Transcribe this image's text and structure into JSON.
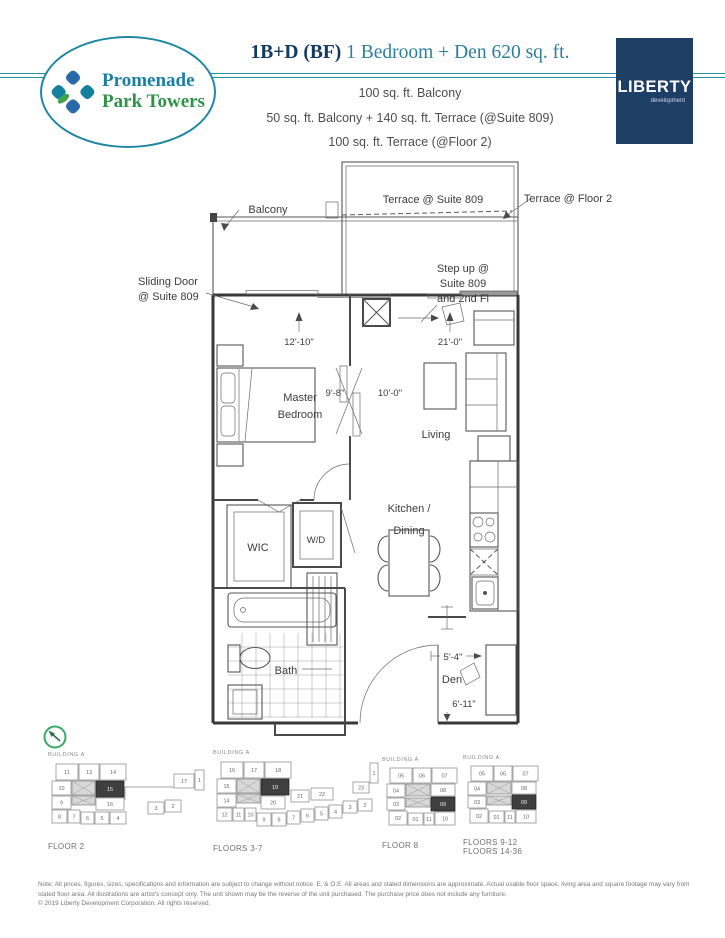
{
  "header": {
    "logo": {
      "line1": "Promenade",
      "line2": "Park Towers"
    },
    "unit_code": "1B+D (BF)",
    "unit_desc": "1 Bedroom + Den 620 sq. ft.",
    "area_lines": [
      "100 sq. ft. Balcony",
      "50 sq. ft. Balcony  + 140 sq. ft. Terrace (@Suite 809)",
      "100 sq. ft. Terrace (@Floor 2)"
    ],
    "developer": {
      "name": "LIBERTY",
      "tagline": "development"
    }
  },
  "plan": {
    "labels": {
      "terrace_suite": "Terrace @ Suite 809",
      "terrace_floor": "Terrace @ Floor 2",
      "balcony": "Balcony",
      "sliding_door": [
        "Sliding Door",
        "@ Suite 809"
      ],
      "step_up": [
        "Step up @",
        "Suite 809",
        "and 2nd Fl"
      ],
      "master_bedroom": [
        "Master",
        "Bedroom"
      ],
      "living": "Living",
      "kitchen_dining": [
        "Kitchen /",
        "Dining"
      ],
      "wic": "WIC",
      "wd": "W/D",
      "bath": "Bath",
      "den": "Den"
    },
    "dimensions": {
      "bedroom_width": "12'-10\"",
      "living_width": "21'-0\"",
      "bedroom_depth": "9'-8\"",
      "living_depth": "10'-0\"",
      "den_width": "5'-4\"",
      "den_depth": "6'-11\""
    }
  },
  "keyplans": [
    {
      "building": "BUILDING A",
      "floors": [
        "FLOOR 2"
      ],
      "shape": "podium16",
      "highlight": "15",
      "units": [
        "11",
        "13",
        "14",
        "10",
        "15",
        "9",
        "16",
        "8",
        "7",
        "6",
        "5",
        "4",
        "3",
        "2",
        "17",
        "1"
      ]
    },
    {
      "building": "BUILDING A",
      "floors": [
        "FLOORS 3-7"
      ],
      "shape": "podium22",
      "highlight": "19",
      "units": [
        "16",
        "17",
        "18",
        "15",
        "19",
        "14",
        "20",
        "12",
        "11",
        "10",
        "9",
        "8",
        "7",
        "6",
        "5",
        "4",
        "3",
        "2",
        "21",
        "22",
        "23",
        "1"
      ]
    },
    {
      "building": "BUILDING A",
      "floors": [
        "FLOOR 8"
      ],
      "shape": "tower",
      "highlight": "09",
      "units": [
        "05",
        "06",
        "07",
        "04",
        "08",
        "03",
        "09",
        "02",
        "01",
        "11",
        "10"
      ]
    },
    {
      "building": "BUILDING A",
      "floors": [
        "FLOORS 9-12",
        "FLOORS 14-36"
      ],
      "shape": "tower",
      "highlight": "09",
      "units": [
        "05",
        "06",
        "07",
        "04",
        "08",
        "03",
        "09",
        "02",
        "01",
        "11",
        "10"
      ]
    }
  ],
  "footer": {
    "note": "Note: All prices, figures, sizes, specifications and information are subject to change without notice. E. & O.E. All areas and stated dimensions are approximate. Actual usable floor space, living area and square footage may vary from stated floor area. All illustrations are artist's concept only. The unit shown may be the reverse of the unit purchased. The purchase price does not include any furniture.",
    "copyright": "© 2019 Liberty Development Corporation. All rights reserved."
  }
}
